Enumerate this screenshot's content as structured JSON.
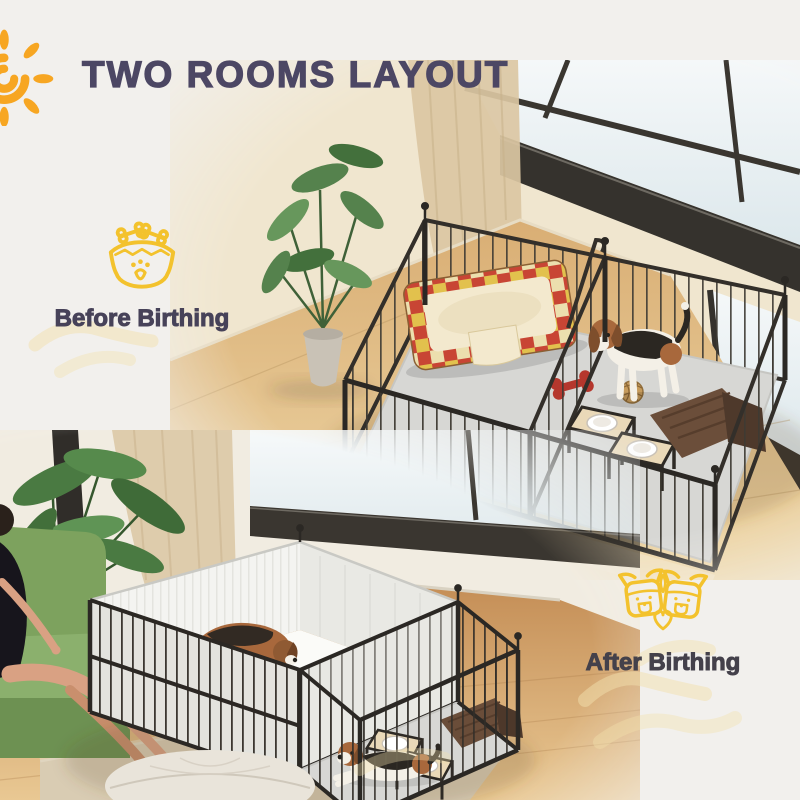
{
  "header": {
    "title": "TWO ROOMS LAYOUT",
    "title_color": "#4c4764",
    "sun_icon_color": "#f7a622"
  },
  "labels": {
    "before": {
      "text": "Before Birthing",
      "color": "#474259",
      "icon": "dog-bowl-icon"
    },
    "after": {
      "text": "After Birthing",
      "color": "#44414b",
      "icon": "puppies-heart-icon"
    }
  },
  "style": {
    "background": "#f2f0ed",
    "icon_stroke_yellow": "#f3c22d",
    "brush_stroke_yellow": "#f2e0ad",
    "pen_metal": "#2b2824",
    "mat_gray": "#d7d7d4",
    "wood_floor": "#d9ae74",
    "sofa_green": "#7da25e",
    "bed_plaid_red": "#c84534",
    "bed_plaid_yellow": "#e2c14d"
  },
  "scenes": {
    "top": {
      "name": "before-birthing-scene",
      "description": "Two-room metal playpen on wood floor with plaid dog bed, bone toy, rattan ball, feeding steps, folded blanket and a standing beagle near a window"
    },
    "bottom": {
      "name": "after-birthing-scene",
      "description": "Playpen with fabric-lined whelping room holding mother beagle and puppies, open room with lying beagle, feeding steps and blanket, beside green sofa with seated woman, plant, rug and pouf"
    }
  }
}
